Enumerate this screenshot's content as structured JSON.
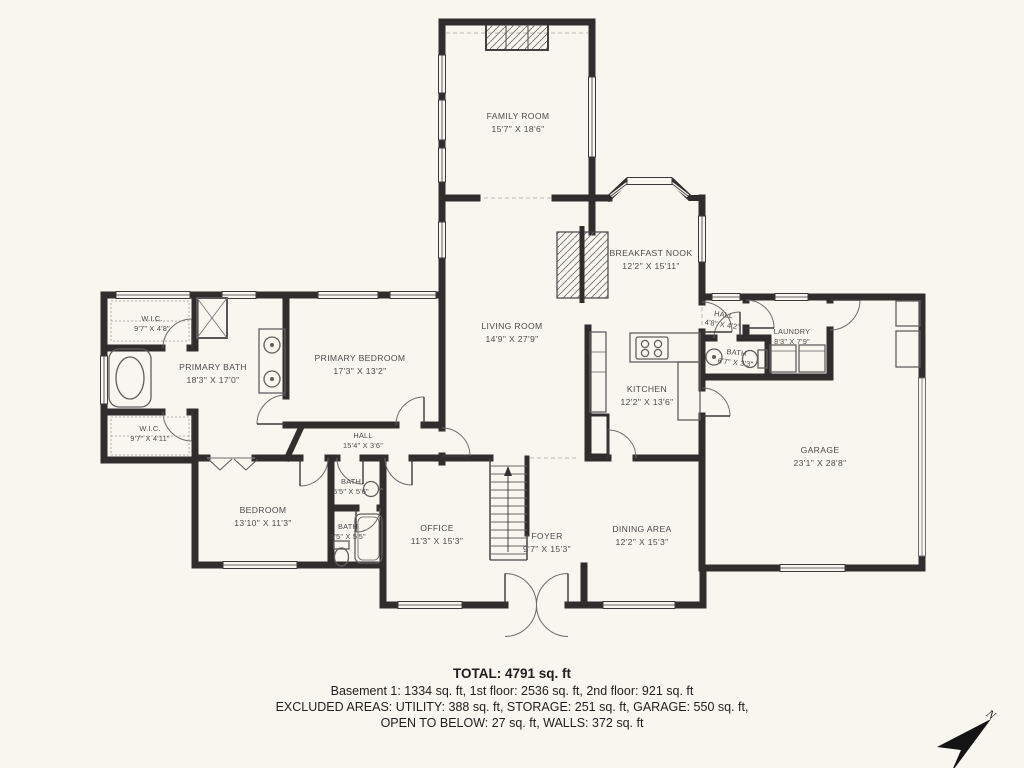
{
  "title": "Floor plan",
  "colors": {
    "background": "#f7f6ef",
    "wall": "#2f2e2c"
  },
  "rooms": [
    {
      "id": "family-room",
      "name": "FAMILY ROOM",
      "dims": "15'7\" X 18'6\""
    },
    {
      "id": "breakfast-nook",
      "name": "BREAKFAST NOOK",
      "dims": "12'2\" X 15'11\""
    },
    {
      "id": "living-room",
      "name": "LIVING ROOM",
      "dims": "14'9\" X 27'9\""
    },
    {
      "id": "kitchen",
      "name": "KITCHEN",
      "dims": "12'2\" X 13'6\""
    },
    {
      "id": "hall-small",
      "name": "HALL",
      "dims": "4'8\" X 4'2\""
    },
    {
      "id": "laundry",
      "name": "LAUNDRY",
      "dims": "8'3\" X 7'9\""
    },
    {
      "id": "bath-hall",
      "name": "BATH",
      "dims": "6'7\" X 3'3\""
    },
    {
      "id": "garage",
      "name": "GARAGE",
      "dims": "23'1\" X 28'8\""
    },
    {
      "id": "wic-upper",
      "name": "W.I.C.",
      "dims": "9'7\" X 4'8\""
    },
    {
      "id": "primary-bath",
      "name": "PRIMARY BATH",
      "dims": "18'3\" X 17'0\""
    },
    {
      "id": "primary-bedroom",
      "name": "PRIMARY BEDROOM",
      "dims": "17'3\" X 13'2\""
    },
    {
      "id": "wic-lower",
      "name": "W.I.C.",
      "dims": "9'7\" X 4'11\""
    },
    {
      "id": "hall-main",
      "name": "HALL",
      "dims": "15'4\" X 3'6\""
    },
    {
      "id": "bedroom",
      "name": "BEDROOM",
      "dims": "13'10\" X 11'3\""
    },
    {
      "id": "bath-upper",
      "name": "BATH",
      "dims": "5'5\" X 5'6\""
    },
    {
      "id": "bath-lower",
      "name": "BATH",
      "dims": "5'5\" X 5'5\""
    },
    {
      "id": "office",
      "name": "OFFICE",
      "dims": "11'3\" X 15'3\""
    },
    {
      "id": "foyer",
      "name": "FOYER",
      "dims": "9'7\" X 15'3\""
    },
    {
      "id": "dining-area",
      "name": "DINING AREA",
      "dims": "12'2\" X 15'3\""
    }
  ],
  "footer": {
    "total": "TOTAL: 4791 sq. ft",
    "line1": "Basement 1: 1334 sq. ft, 1st floor: 2536 sq. ft, 2nd floor: 921 sq. ft",
    "line2": "EXCLUDED AREAS: UTILITY: 388 sq. ft, STORAGE: 251 sq. ft, GARAGE: 550 sq. ft,",
    "line3": "OPEN TO BELOW: 27 sq. ft, WALLS: 372 sq. ft"
  },
  "compass": {
    "label": "N"
  }
}
